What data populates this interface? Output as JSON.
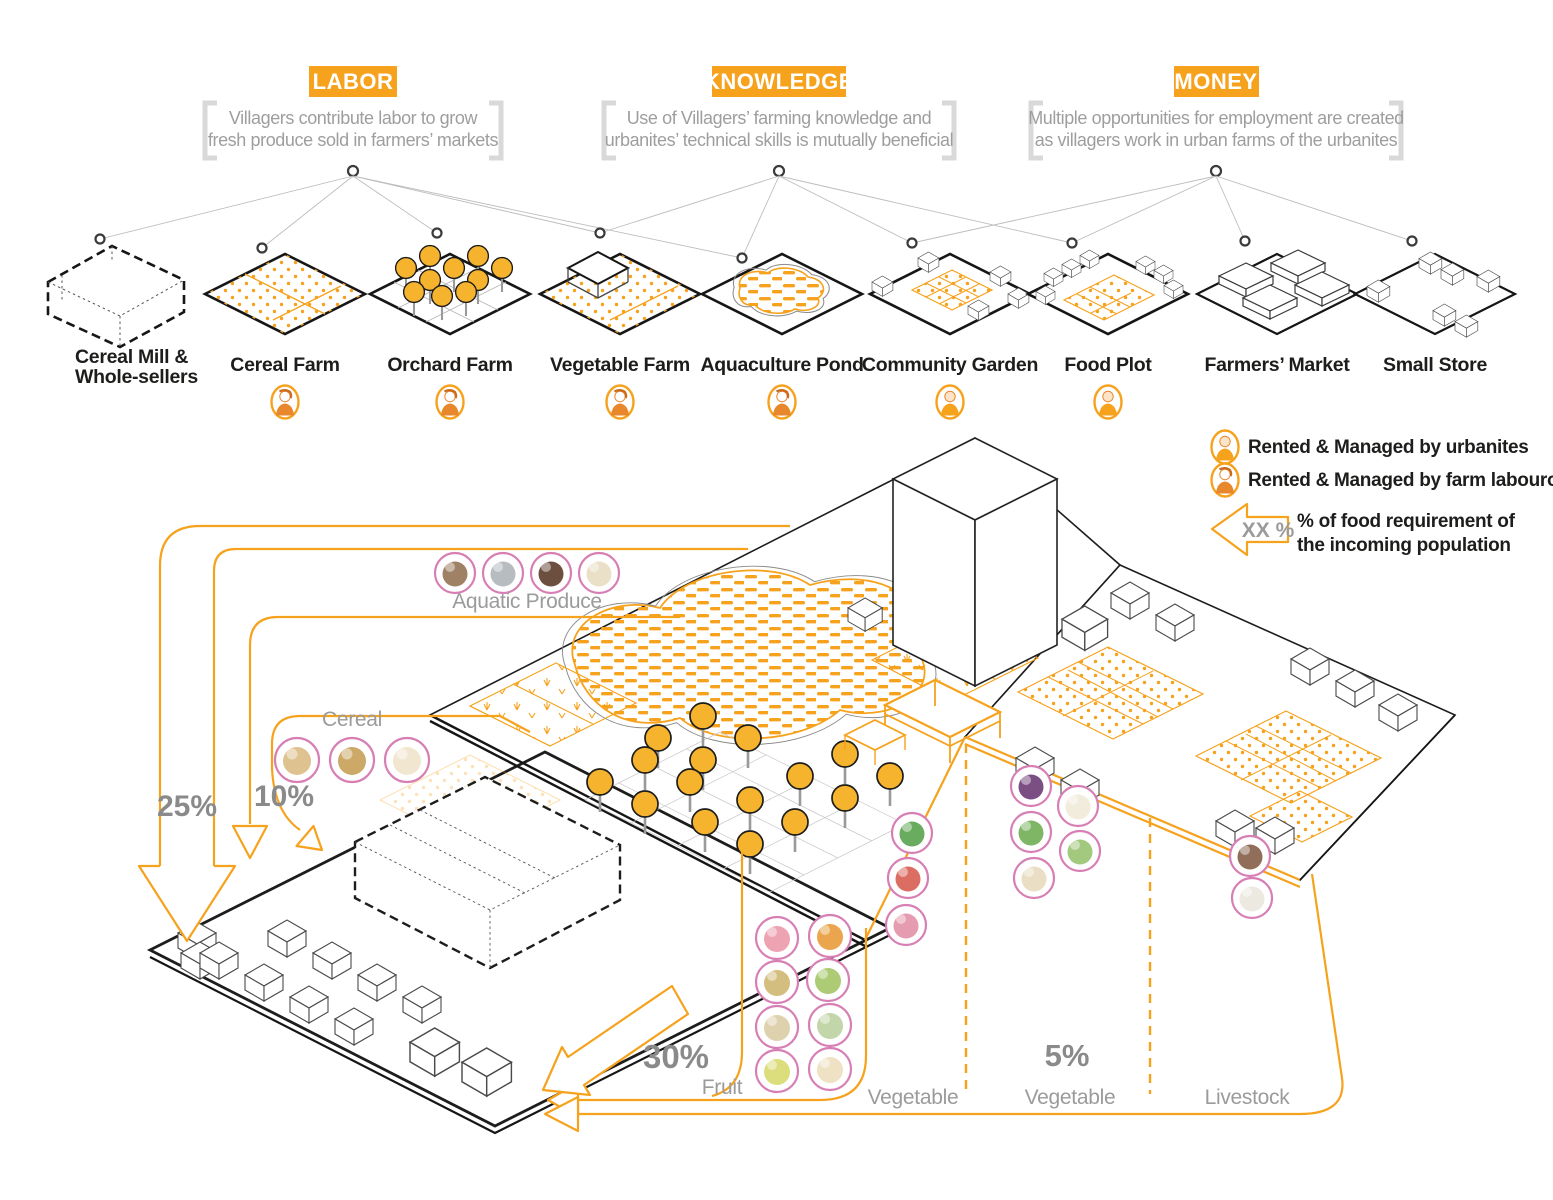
{
  "palette": {
    "orange": "#F6A21D",
    "orange_dark": "#E8872B",
    "gray_label": "#9B9B9B",
    "percent_gray": "#8A8A8A",
    "pink": "#D77FB4",
    "ink": "#1D1D1B"
  },
  "concepts": [
    {
      "title": "LABOR",
      "line1": "Villagers contribute labor to grow",
      "line2": "fresh produce sold in farmers’ markets"
    },
    {
      "title": "KNOWLEDGE",
      "line1": "Use of Villagers’ farming knowledge and",
      "line2": "urbanites’ technical skills is mutually beneficial"
    },
    {
      "title": "MONEY",
      "line1": "Multiple opportunities for employment are created",
      "line2": "as villagers work in urban farms of the urbanites"
    }
  ],
  "facilities": [
    {
      "label": "Cereal Mill &",
      "label2": "Whole-sellers",
      "manager": null
    },
    {
      "label": "Cereal Farm",
      "manager": "farm-labourer"
    },
    {
      "label": "Orchard Farm",
      "manager": "farm-labourer"
    },
    {
      "label": "Vegetable Farm",
      "manager": "farm-labourer"
    },
    {
      "label": "Aquaculture Pond",
      "manager": "farm-labourer"
    },
    {
      "label": "Community Garden",
      "manager": "urbanite"
    },
    {
      "label": "Food Plot",
      "manager": "urbanite"
    },
    {
      "label": "Farmers’ Market",
      "manager": null
    },
    {
      "label": "Small Store",
      "manager": null
    }
  ],
  "legend": {
    "urbanite": "Rented & Managed by urbanites",
    "labourer": "Rented & Managed by farm labouror",
    "arrow_value": "XX %",
    "arrow_line1": "% of food requirement of",
    "arrow_line2": "the incoming population"
  },
  "flows": {
    "aquatic": {
      "label": "Aquatic Produce",
      "percent": "25%"
    },
    "cereal": {
      "label": "Cereal",
      "percent": "10%"
    },
    "fruit": {
      "label": "Fruit",
      "percent": "30%"
    },
    "vegetable_fresh": {
      "label": "Vegetable"
    },
    "vegetable_garden": {
      "label": "Vegetable",
      "percent": "5%"
    },
    "livestock": {
      "label": "Livestock"
    }
  },
  "produce": {
    "aquatic_items": [
      {
        "name": "carp",
        "color": "#8e6b4a"
      },
      {
        "name": "tilapia",
        "color": "#a9b0b4"
      },
      {
        "name": "water-chestnut",
        "color": "#53301f"
      },
      {
        "name": "lotus-root",
        "color": "#e6d9bd"
      }
    ],
    "cereal_items": [
      {
        "name": "soybean",
        "color": "#d8b87c"
      },
      {
        "name": "wheat",
        "color": "#c49a4e"
      },
      {
        "name": "rice",
        "color": "#eee3c8"
      }
    ],
    "fruit_items": [
      {
        "name": "guava",
        "color": "#ea93a4"
      },
      {
        "name": "mango",
        "color": "#e7952f"
      },
      {
        "name": "jackfruit",
        "color": "#cbb36a"
      },
      {
        "name": "lime",
        "color": "#9dc25c"
      },
      {
        "name": "bael-fruit",
        "color": "#d8c9a0"
      },
      {
        "name": "custard-apple",
        "color": "#b9cf9a"
      },
      {
        "name": "pear",
        "color": "#d6d766"
      },
      {
        "name": "cashew",
        "color": "#ecdcb8"
      }
    ],
    "vegetable_fresh_items": [
      {
        "name": "leafy-greens",
        "color": "#4f9e43"
      },
      {
        "name": "tomato",
        "color": "#d65348"
      },
      {
        "name": "radish",
        "color": "#e08aa2"
      }
    ],
    "vegetable_garden_items": [
      {
        "name": "eggplant",
        "color": "#64306e"
      },
      {
        "name": "cauliflower",
        "color": "#efe9d6"
      },
      {
        "name": "okra",
        "color": "#69a94b"
      },
      {
        "name": "cabbage",
        "color": "#93c068"
      },
      {
        "name": "white-beans",
        "color": "#e6d8ba"
      }
    ],
    "livestock_items": [
      {
        "name": "cattle",
        "color": "#7d553d"
      },
      {
        "name": "poultry",
        "color": "#e9e5dc"
      }
    ]
  }
}
